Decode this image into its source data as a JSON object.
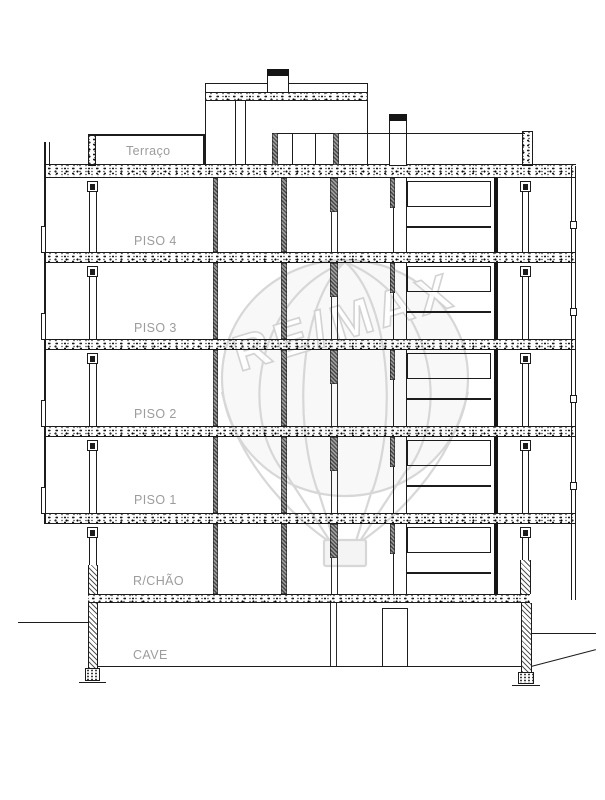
{
  "drawing_title": "building-cross-section",
  "floors": [
    {
      "label": "Terraço"
    },
    {
      "label": "PISO 4"
    },
    {
      "label": "PISO 3"
    },
    {
      "label": "PISO 2"
    },
    {
      "label": "PISO 1"
    },
    {
      "label": "R/CHÃO"
    },
    {
      "label": "CAVE"
    }
  ],
  "watermark": {
    "text": "RE/MAX"
  },
  "colors": {
    "line": "#1c1c1c",
    "label_gray": "#9c9c9c",
    "watermark_gray": "#d7d7d7",
    "paper": "#ffffff",
    "chimney_cap": "#000000"
  }
}
